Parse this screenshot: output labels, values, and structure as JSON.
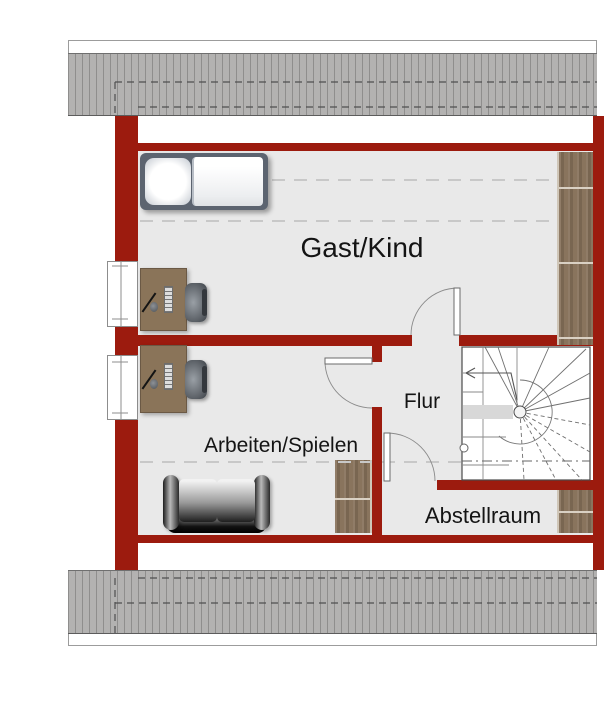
{
  "plan_title": "Dachgeschoss Grundriss",
  "rooms": [
    {
      "id": "gast-kind",
      "label": "Gast/Kind"
    },
    {
      "id": "arbeiten-spielen",
      "label": "Arbeiten/Spielen"
    },
    {
      "id": "flur",
      "label": "Flur"
    },
    {
      "id": "abstellraum",
      "label": "Abstellraum"
    }
  ],
  "colors": {
    "wall": "#9c1b0e",
    "floor": "#e9e9e9",
    "roof_hatch": "#b3b2b1",
    "wood": "#87715a",
    "stair_lines": "#6f6f6f"
  },
  "furniture": [
    {
      "name": "bed",
      "room": "Gast/Kind"
    },
    {
      "name": "wardrobe",
      "room": "Gast/Kind"
    },
    {
      "name": "desk-with-chair",
      "room": "Gast/Kind"
    },
    {
      "name": "desk-with-chair",
      "room": "Arbeiten/Spielen"
    },
    {
      "name": "sofa",
      "room": "Arbeiten/Spielen"
    },
    {
      "name": "cabinet",
      "room": "Arbeiten/Spielen"
    },
    {
      "name": "cabinet",
      "room": "Abstellraum"
    },
    {
      "name": "winder-staircase",
      "room": "Flur"
    }
  ]
}
